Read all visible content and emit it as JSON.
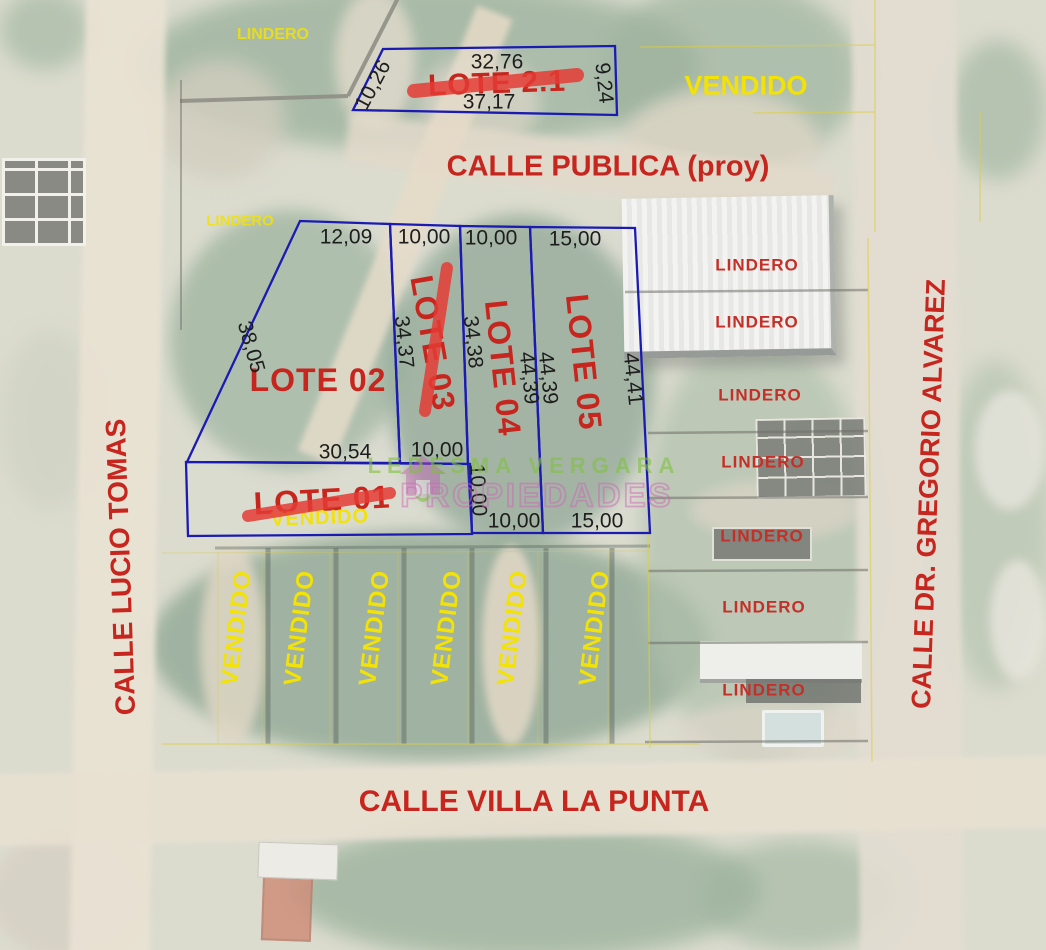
{
  "streets": {
    "top": "CALLE PUBLICA (proy)",
    "bottom": "CALLE VILLA LA PUNTA",
    "left": "CALLE LUCIO TOMAS",
    "right": "CALLE DR. GREGORIO ALVAREZ"
  },
  "labels": {
    "lindero": "LINDERO",
    "vendido": "VENDIDO"
  },
  "lots": {
    "lote21": {
      "name": "LOTE 2.1",
      "sold": true,
      "top": "32,76",
      "bottom": "37,17",
      "left": "10,26",
      "right": "9,24"
    },
    "lote01": {
      "name": "LOTE 01",
      "sold": true,
      "status": "VENDIDO"
    },
    "lote02": {
      "name": "LOTE 02",
      "top": "12,09",
      "left": "38,05",
      "bottom": "30,54"
    },
    "lote03": {
      "name": "LOTE 03",
      "sold": true,
      "top": "10,00",
      "left": "34,37",
      "bottom": "10,00"
    },
    "lote04": {
      "name": "LOTE 04",
      "top": "10,00",
      "left": "34,38",
      "right": "44,39",
      "lower_left": "10,00",
      "bottom": "10,00"
    },
    "lote05": {
      "name": "LOTE 05",
      "top": "15,00",
      "left": "44,39",
      "right": "44,41",
      "bottom": "15,00"
    }
  },
  "watermark": {
    "line1": "LEDESMA VERGARA",
    "line2": "PROPIEDADES"
  },
  "colors": {
    "lot_boundary_blue": "#1b1bb2",
    "label_red": "#c6261e",
    "label_yellow": "#f2e205",
    "measure_black": "#1d1d1d",
    "strike_red": "#e43c35",
    "watermark_green": "#7fc13d",
    "watermark_pink": "#cf66b8"
  }
}
